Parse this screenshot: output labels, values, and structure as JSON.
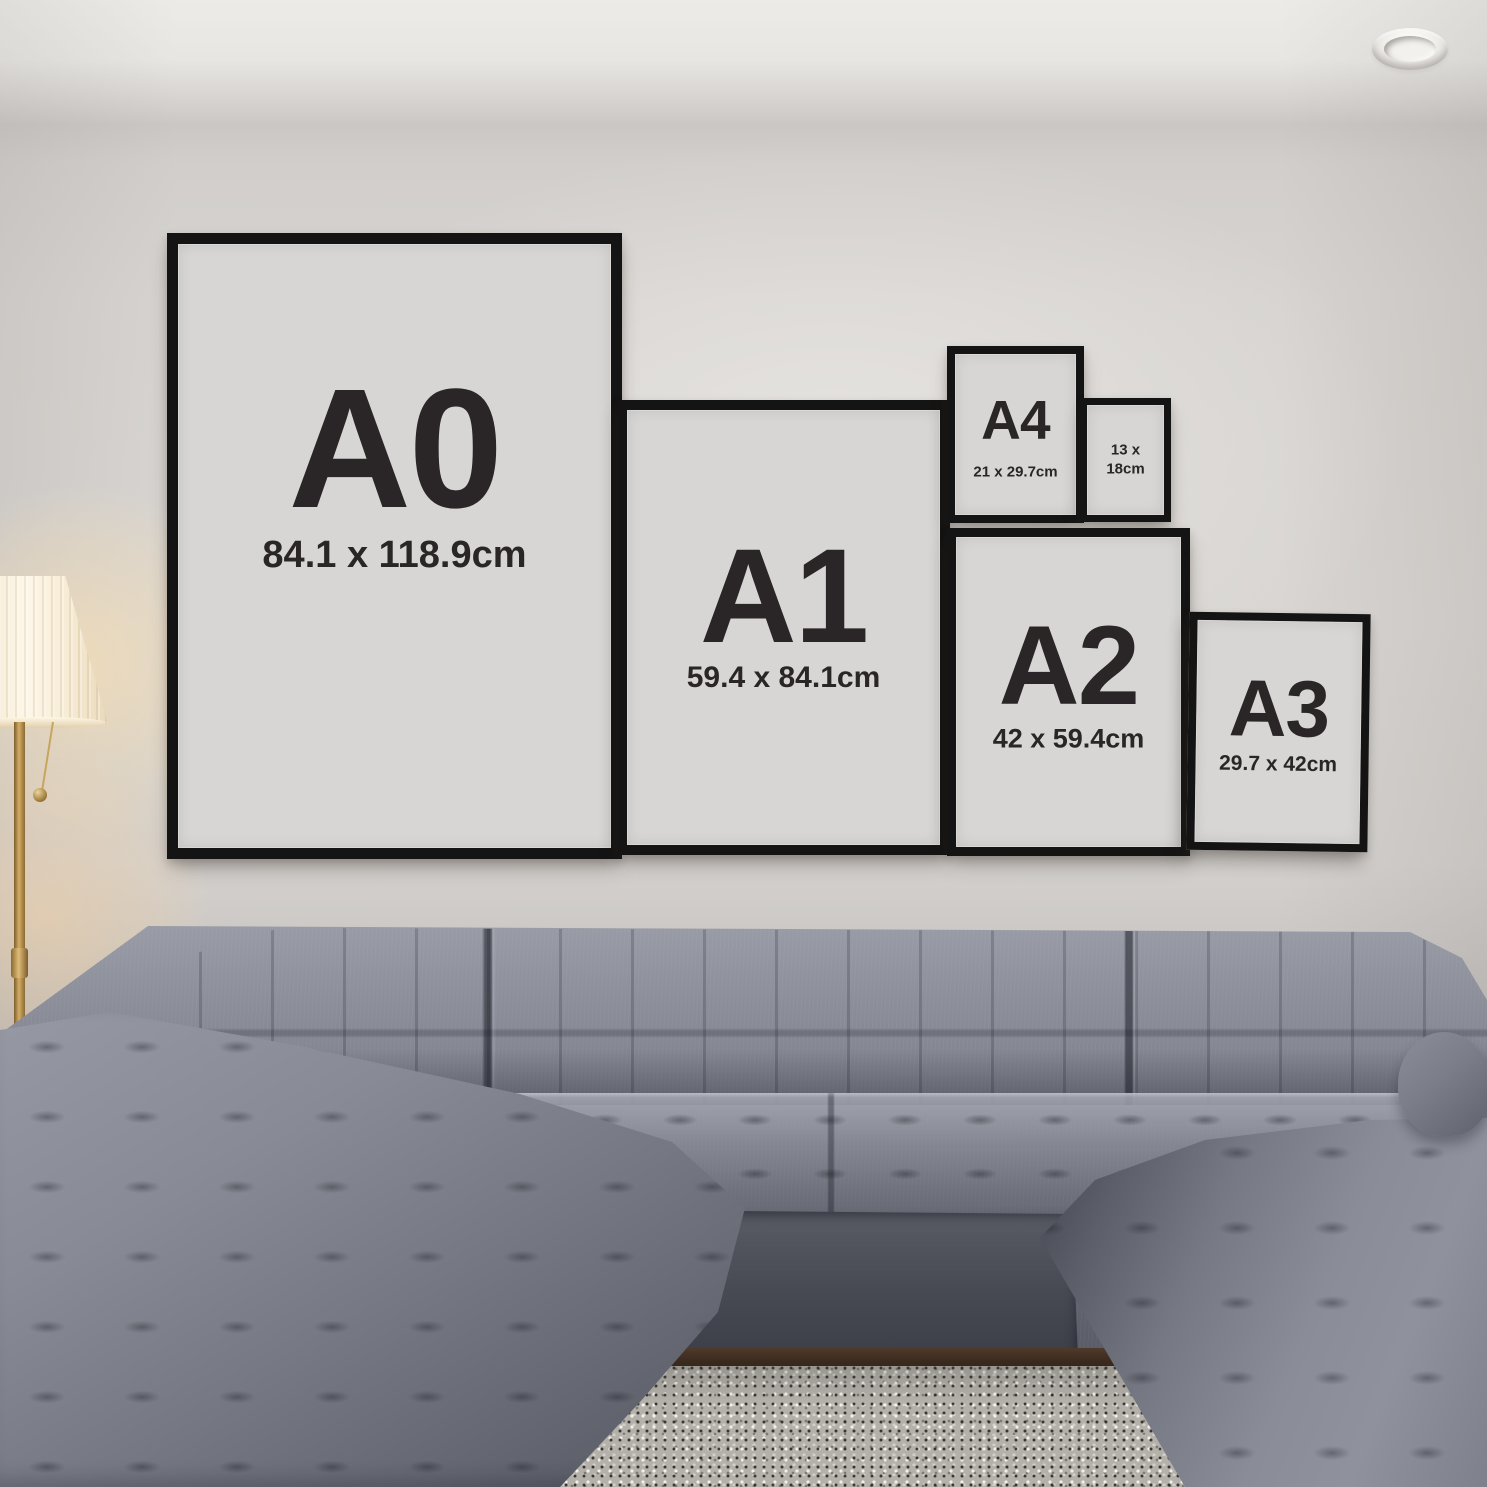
{
  "frames": [
    {
      "label": "A0",
      "size": "84.1 x 118.9cm"
    },
    {
      "label": "A1",
      "size": "59.4 x 84.1cm"
    },
    {
      "label": "A4",
      "size": "21 x 29.7cm"
    },
    {
      "size_line1": "13 x",
      "size_line2": "18cm"
    },
    {
      "label": "A2",
      "size": "42 x 59.4cm"
    },
    {
      "label": "A3",
      "size": "29.7 x 42cm"
    }
  ],
  "colors": {
    "frame": "#141414",
    "poster": "#d8d6d4",
    "text": "#2a2526",
    "wall": "#d5d2cf",
    "sofa": "#7b7e89",
    "rug": "#b4b1ab",
    "lamp_shade": "#f7ecd6",
    "lamp_brass": "#b28d4e",
    "wood_floor": "#3a2a1e"
  }
}
